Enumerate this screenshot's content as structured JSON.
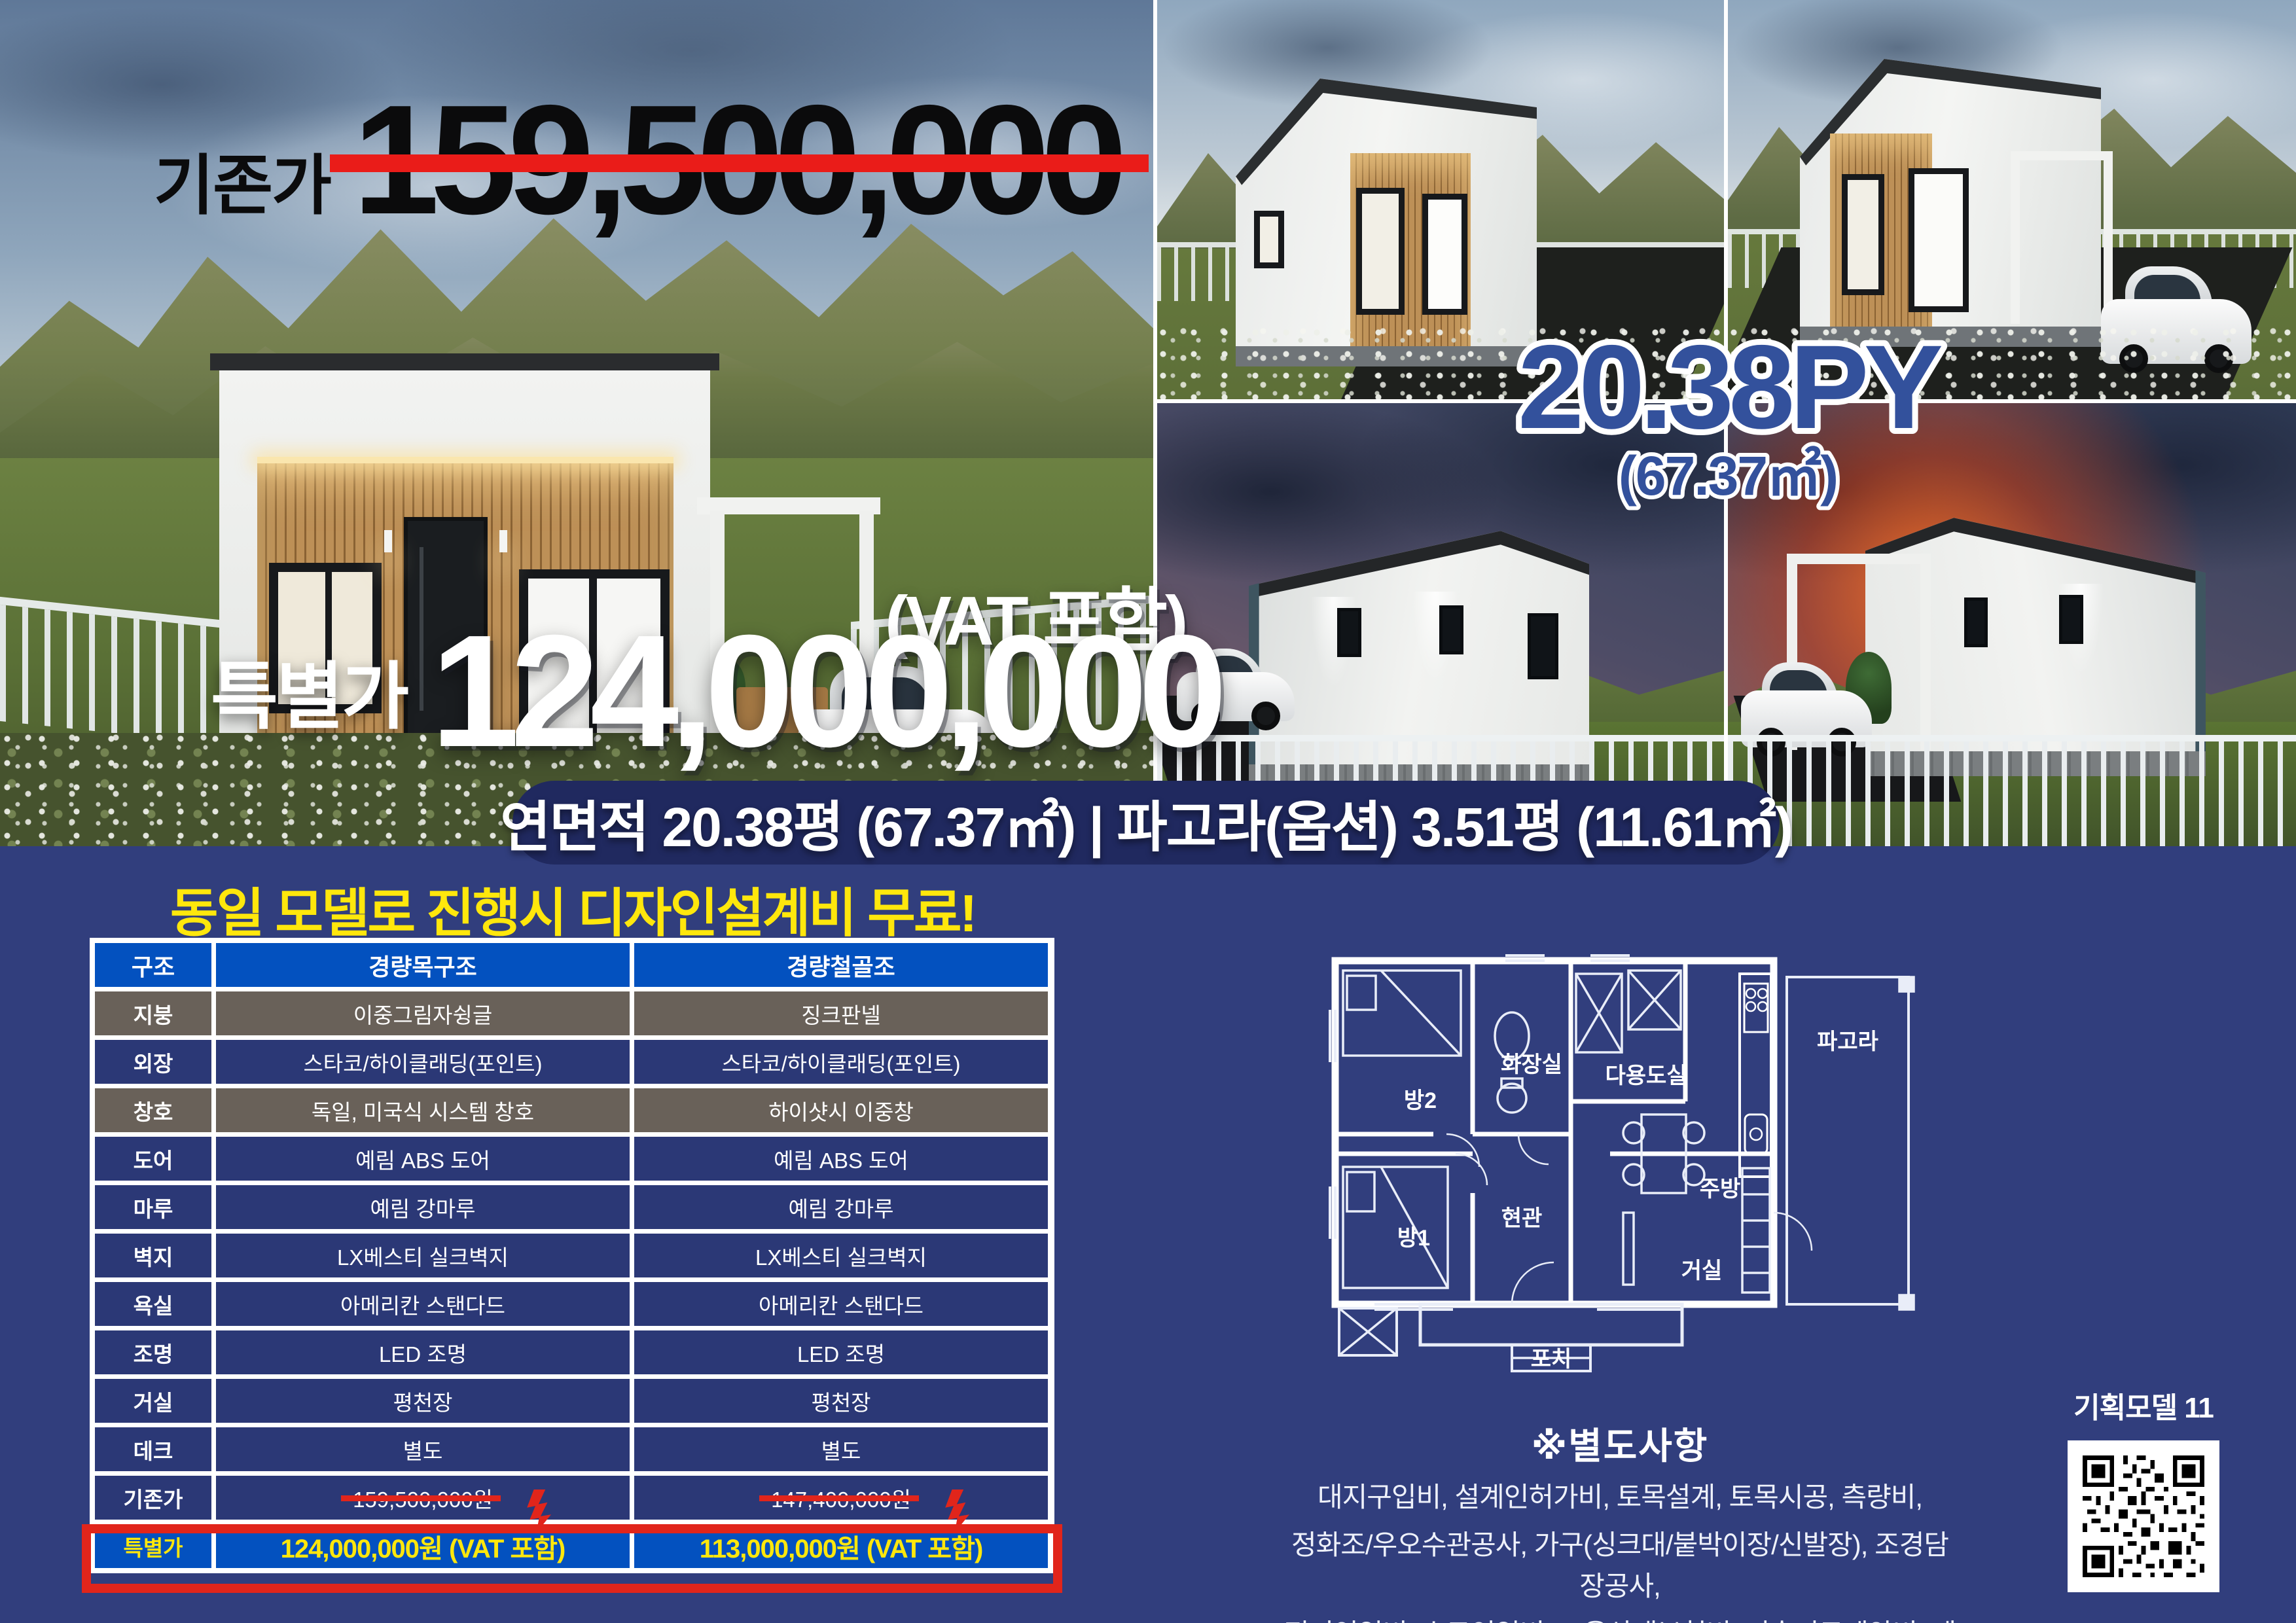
{
  "hero": {
    "old_price_label": "기존가",
    "old_price": "159,500,000",
    "special_price_label": "특별가",
    "special_price": "124,000,000",
    "vat_note": "(VAT 포함)",
    "area_py": "20.38PY",
    "area_m2": "(67.37㎡)",
    "banner": "연면적 20.38평 (67.37㎡)  |  파고라(옵션) 3.51평 (11.61㎡)"
  },
  "promo": {
    "headline": "동일 모델로 진행시 디자인설계비 무료!"
  },
  "spec_table": {
    "columns": [
      "구조",
      "경량목구조",
      "경량철골조"
    ],
    "rows": [
      {
        "label": "지붕",
        "wood": "이중그림자슁글",
        "steel": "징크판넬"
      },
      {
        "label": "외장",
        "wood": "스타코/하이클래딩(포인트)",
        "steel": "스타코/하이클래딩(포인트)"
      },
      {
        "label": "창호",
        "wood": "독일, 미국식 시스템 창호",
        "steel": "하이샷시 이중창"
      },
      {
        "label": "도어",
        "wood": "예림 ABS 도어",
        "steel": "예림 ABS 도어"
      },
      {
        "label": "마루",
        "wood": "예림 강마루",
        "steel": "예림 강마루"
      },
      {
        "label": "벽지",
        "wood": "LX베스티 실크벽지",
        "steel": "LX베스티 실크벽지"
      },
      {
        "label": "욕실",
        "wood": "아메리칸 스탠다드",
        "steel": "아메리칸 스탠다드"
      },
      {
        "label": "조명",
        "wood": "LED 조명",
        "steel": "LED 조명"
      },
      {
        "label": "거실",
        "wood": "평천장",
        "steel": "평천장"
      },
      {
        "label": "데크",
        "wood": "별도",
        "steel": "별도"
      },
      {
        "label": "기존가",
        "wood": "159,500,000원",
        "steel": "147,400,000원"
      },
      {
        "label": "특별가",
        "wood": "124,000,000원 (VAT 포함)",
        "steel": "113,000,000원 (VAT 포함)"
      }
    ]
  },
  "floor_plan": {
    "rooms": [
      "방2",
      "화장실",
      "다용도실",
      "주방",
      "현관",
      "거실",
      "방1",
      "포치",
      "파고라"
    ]
  },
  "extras": {
    "title": "※별도사항",
    "lines": [
      "대지구입비, 설계인허가비, 토목설계, 토목시공, 측량비,",
      "정화조/우오수관공사, 가구(싱크대/붙박이장/신발장), 조경담장공사,",
      "전기인입비, 수도인입비, 고용산재보험비, 기술지도계약비, 데크공사"
    ]
  },
  "model": {
    "label": "기획모델 11"
  },
  "colors": {
    "background": "#313E7D",
    "table_header_blue": "#0351BF",
    "row_navy": "#2B3876",
    "row_gray": "#696159",
    "accent_red": "#E1251B",
    "accent_yellow": "#FFE70C",
    "banner_navy": "#20295F",
    "size_text_blue": "#33519C"
  }
}
